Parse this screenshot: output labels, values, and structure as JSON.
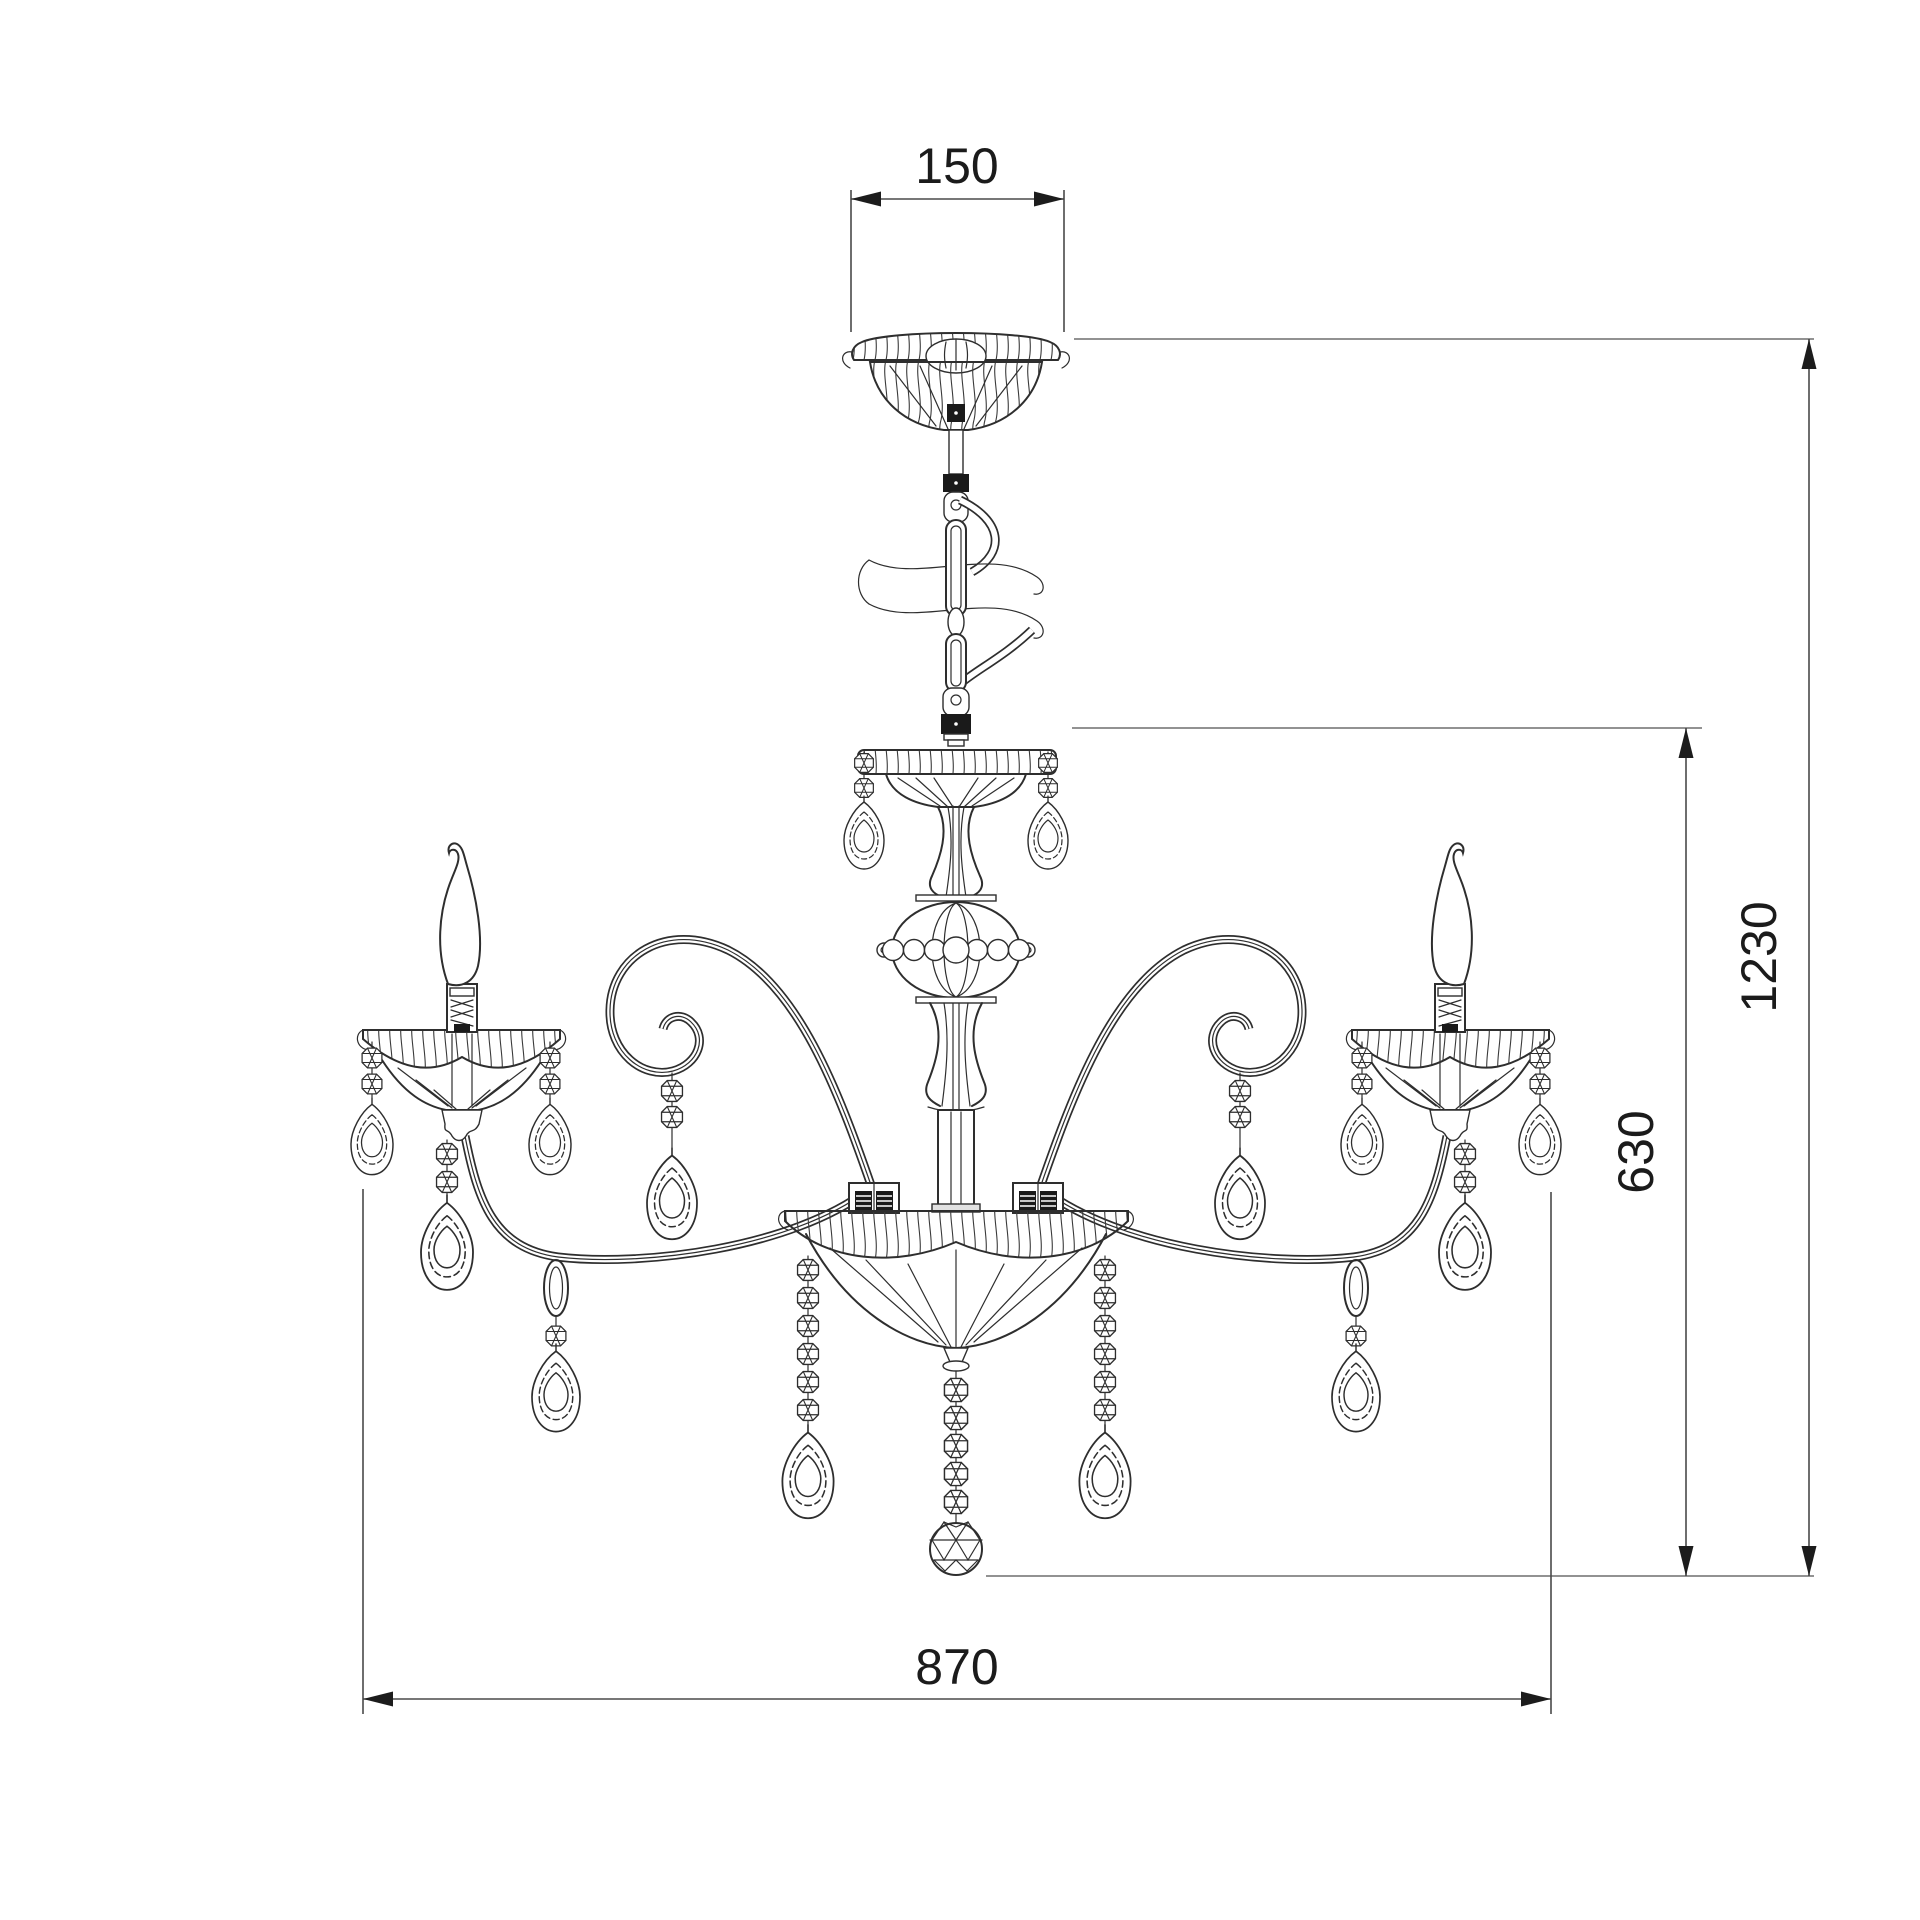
{
  "drawing": {
    "background": "#ffffff",
    "line_color": "#2e2e2e",
    "dimension_line_color": "#4a4a4a",
    "text_color": "#1b1b1b",
    "dimensions": {
      "canopy_diameter": "150",
      "overall_height": "1230",
      "body_height": "630",
      "overall_width": "870"
    }
  }
}
